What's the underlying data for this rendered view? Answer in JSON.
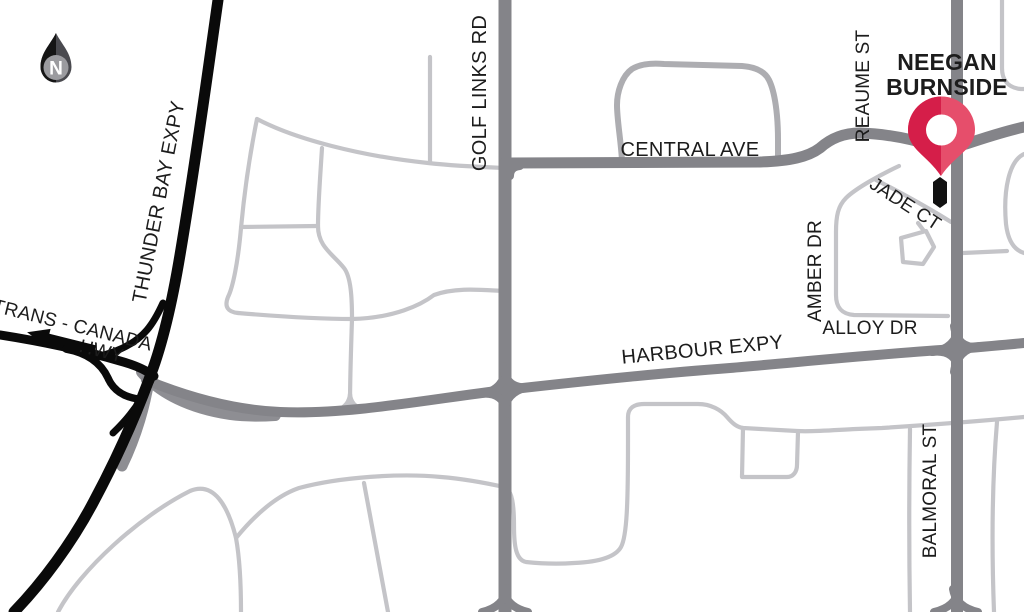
{
  "map": {
    "compass": {
      "letter": "N"
    },
    "labels": {
      "thunder_bay_expy": "THUNDER BAY EXPY",
      "trans_canada": "TRANS - CANADA",
      "hwy": "HWY",
      "golf_links_rd": "GOLF LINKS RD",
      "central_ave": "CENTRAL AVE",
      "harbour_expy": "HARBOUR EXPY",
      "reaume_st": "REAUME ST",
      "jade_ct": "JADE CT",
      "amber_dr": "AMBER DR",
      "alloy_dr": "ALLOY DR",
      "balmoral_st": "BALMORAL ST"
    },
    "marker": {
      "line1": "NEEGAN",
      "line2": "BURNSIDE"
    },
    "colors": {
      "highway_black": "#0a0a0a",
      "road_gray": "#848489",
      "street_light": "#c4c4c8",
      "street_medium": "#adadb1",
      "pin_red_dark": "#d51e49",
      "pin_red_light": "#e64e6b",
      "label_red": "#d41e49",
      "text_black": "#1c1c1c"
    }
  }
}
